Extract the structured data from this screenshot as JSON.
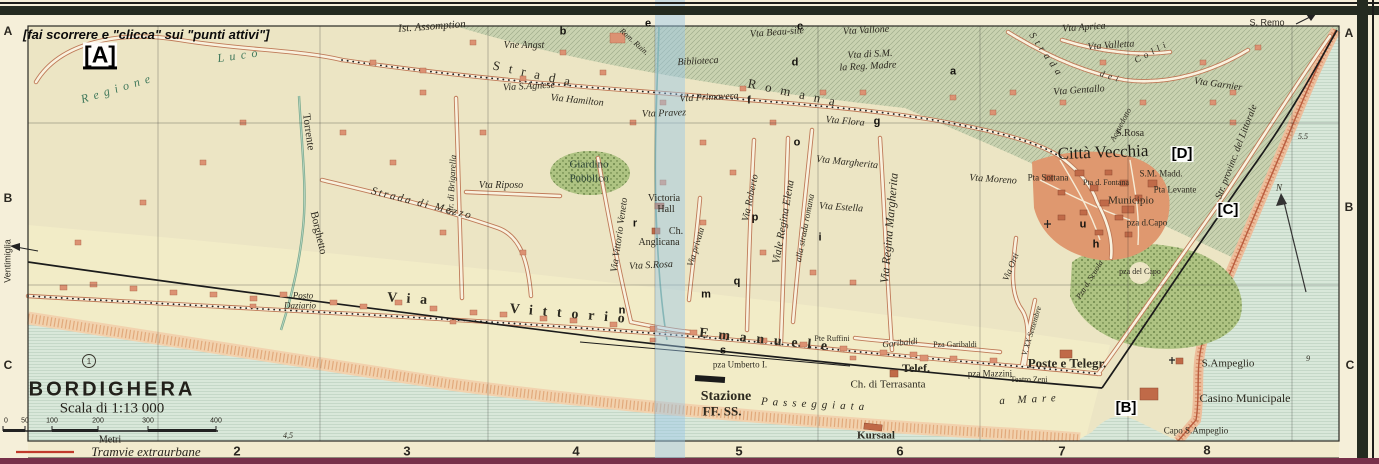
{
  "frame": {
    "instruction": "[fai scorrere e \"clicca\" sui \"punti attivi\"]"
  },
  "hotspots": {
    "a": "[A]",
    "b": "[B]",
    "c": "[C]",
    "d": "[D]"
  },
  "title_block": {
    "title": "BORDIGHERA",
    "scale": "Scala di 1:13 000",
    "unit": "Metri",
    "tram_legend": "Tramvie extraurbane",
    "route_badge": "1",
    "ticks": [
      "0",
      "50",
      "100",
      "200",
      "300",
      "400"
    ]
  },
  "grid": {
    "cols": [
      "2",
      "3",
      "4",
      "5",
      "6",
      "7",
      "8"
    ],
    "left": [
      "A",
      "B",
      "C"
    ],
    "right": [
      "A",
      "B",
      "C"
    ]
  },
  "labels": {
    "regione": "Regione",
    "luco": "Luco",
    "ist_assomption": "Ist. Assomption",
    "vne_angst": "Vne Angst",
    "via_s_agnese": "Via S.Agnese",
    "via_hamilton": "Via Hamilton",
    "strada_w": "Strada",
    "romana_w": "Romana",
    "rom_ruin": "Rom. Ruin.",
    "biblioteca": "Biblioteca",
    "vta_beau_site": "Vta Beau-site",
    "vta_vallone": "Vta Vallone",
    "vta_di_sm": "Vta di S.M.",
    "la_reg_madre": "la Reg. Madre",
    "vta_primavera": "Vta Primavera",
    "vta_pravez": "Vta Pravez",
    "vta_flora": "Vta Flora",
    "vta_aprica": "Vta Aprica",
    "vta_valletta": "Vta Valletta",
    "colli_strada": "Strada",
    "colli_dei": "dei",
    "colli_colli": "Colli",
    "vta_gentallo": "Vta Gentallo",
    "vta_garnier": "Vta Garnier",
    "acquedotto": "Acquedotto",
    "s_remo": "S. Remo",
    "s_rosa_n": "S.Rosa",
    "citta_vecchia": "Città Vecchia",
    "pta_sottana": "Pta Sottana",
    "pta_d_fontana": "Pta d. Fontana",
    "sm_madd": "S.M. Madd.",
    "pta_levante": "Pta Levante",
    "municipio": "Municipio",
    "pza_d_capo": "pza d.Capo",
    "pza_del_capo": "pza del Capo",
    "pza_d_scuola": "Pza d. Scuola",
    "vta_moreno": "Vta Moreno",
    "via_orti": "Via Orti",
    "v_xx_settembre": "V. XX Settembre",
    "str_littorale": "Str. provinc. del Littorale",
    "torrente": "Torrente",
    "borghetto": "Borghetto",
    "strada_di_mezzo": "Strada di Mezzo",
    "str_di_brigarella": "Str. di Brigarella",
    "vta_riposo": "Vta Riposo",
    "giardino": "Giardino",
    "pubblico": "Pubblico",
    "via_vittorio_veneto": "Via Vittorio Veneto",
    "victoria": "Victoria",
    "hall": "Hall",
    "ch": "Ch.",
    "anglicana": "Anglicana",
    "vta_s_rosa": "Vta S.Rosa",
    "via_privata": "Via privata",
    "via_roberto": "Via Roberto",
    "viale_regina_elena": "Viale Regina Elena",
    "alla_strada_romana": "alla strada romana",
    "via_regina_margherita": "Via Regina Margherita",
    "vta_margherita": "Vta Margherita",
    "vta_estella": "Vta Estella",
    "ventimiglia": "Ventimiglia",
    "via_w": "Via",
    "vittorio_w": "Vittorio",
    "emanuele_w": "Emanuele",
    "posto": "Posto",
    "daziario": "Daziario",
    "pte_ruffini": "Pte Ruffini",
    "garibaldi_st": "Garibaldi",
    "pza_garibaldi": "Pza Garibaldi",
    "telef": "Telef.",
    "ch_di_terrasanta": "Ch. di Terrasanta",
    "pza_mazzini": "pza Mazzini",
    "teatro_zeni": "Teatro Zeni",
    "poste_telegr": "Poste e Telegr.",
    "pza_umberto": "pza Umberto I.",
    "stazione": "Stazione",
    "ffss": "FF. SS.",
    "passeggiata": "Passeggiata",
    "a_mare": "a Mare",
    "kursaal": "Kursaal",
    "s_ampeglio": "S.Ampeglio",
    "casino_municipale": "Casino Municipale",
    "capo_s_ampeglio": "Capo S.Ampeglio",
    "compass_n": "N",
    "depth_a": "5.5",
    "depth_b": "9",
    "depth_c": "4,5",
    "mk_a": "a",
    "mk_b": "b",
    "mk_c": "c",
    "mk_d": "d",
    "mk_e": "e",
    "mk_f": "f",
    "mk_g": "g",
    "mk_h": "h",
    "mk_i": "i",
    "mk_m": "m",
    "mk_n": "n",
    "mk_o": "o",
    "mk_p": "p",
    "mk_q": "q",
    "mk_r": "r",
    "mk_s": "s",
    "mk_u": "u"
  }
}
